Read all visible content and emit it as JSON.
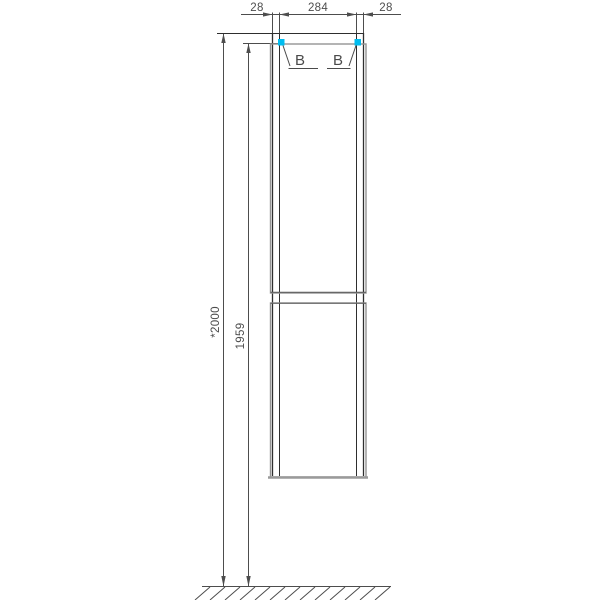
{
  "drawing": {
    "top_dimension": {
      "left_offset": "28",
      "opening_width": "284",
      "right_offset": "28"
    },
    "vertical_dimension": {
      "overall_height": "*2000",
      "door_top_height": "1959"
    },
    "callouts": {
      "left_label": "B",
      "right_label": "B"
    },
    "colors": {
      "dimension_line": "#4d4d4d",
      "cabinet_outline": "#2e2e2e",
      "door_outline": "#949494",
      "detail_marker_cyan": "#00bdf0",
      "background": "#ffffff"
    }
  }
}
